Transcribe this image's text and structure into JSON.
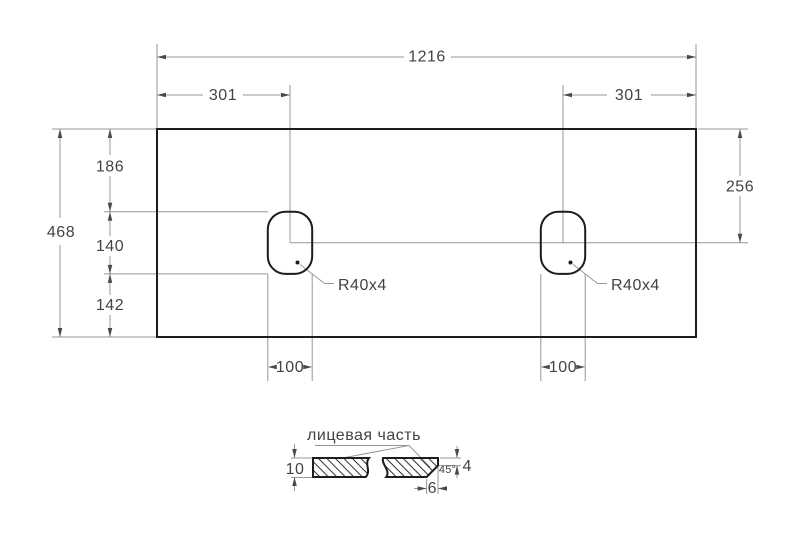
{
  "colors": {
    "background": "#ffffff",
    "outline": "#1d1d1d",
    "dimension": "#979797",
    "arrow": "#4a4a4a",
    "text": "#434343",
    "hatch": "#2f2f2f"
  },
  "top_view": {
    "overall_width": "1216",
    "left_cutout_offset": "301",
    "right_cutout_offset": "301",
    "overall_depth": "468",
    "top_to_cutout": "186",
    "cutout_length": "140",
    "cutout_to_bottom": "142",
    "top_to_cutout_center": "256",
    "left_cutout_width": "100",
    "right_cutout_width": "100",
    "left_corner_radius": "R40x4",
    "right_corner_radius": "R40x4"
  },
  "section_view": {
    "face_label": "лицевая часть",
    "thickness": "10",
    "front_edge_height": "4",
    "chamfer_angle": "45°",
    "chamfer_depth": "6"
  }
}
